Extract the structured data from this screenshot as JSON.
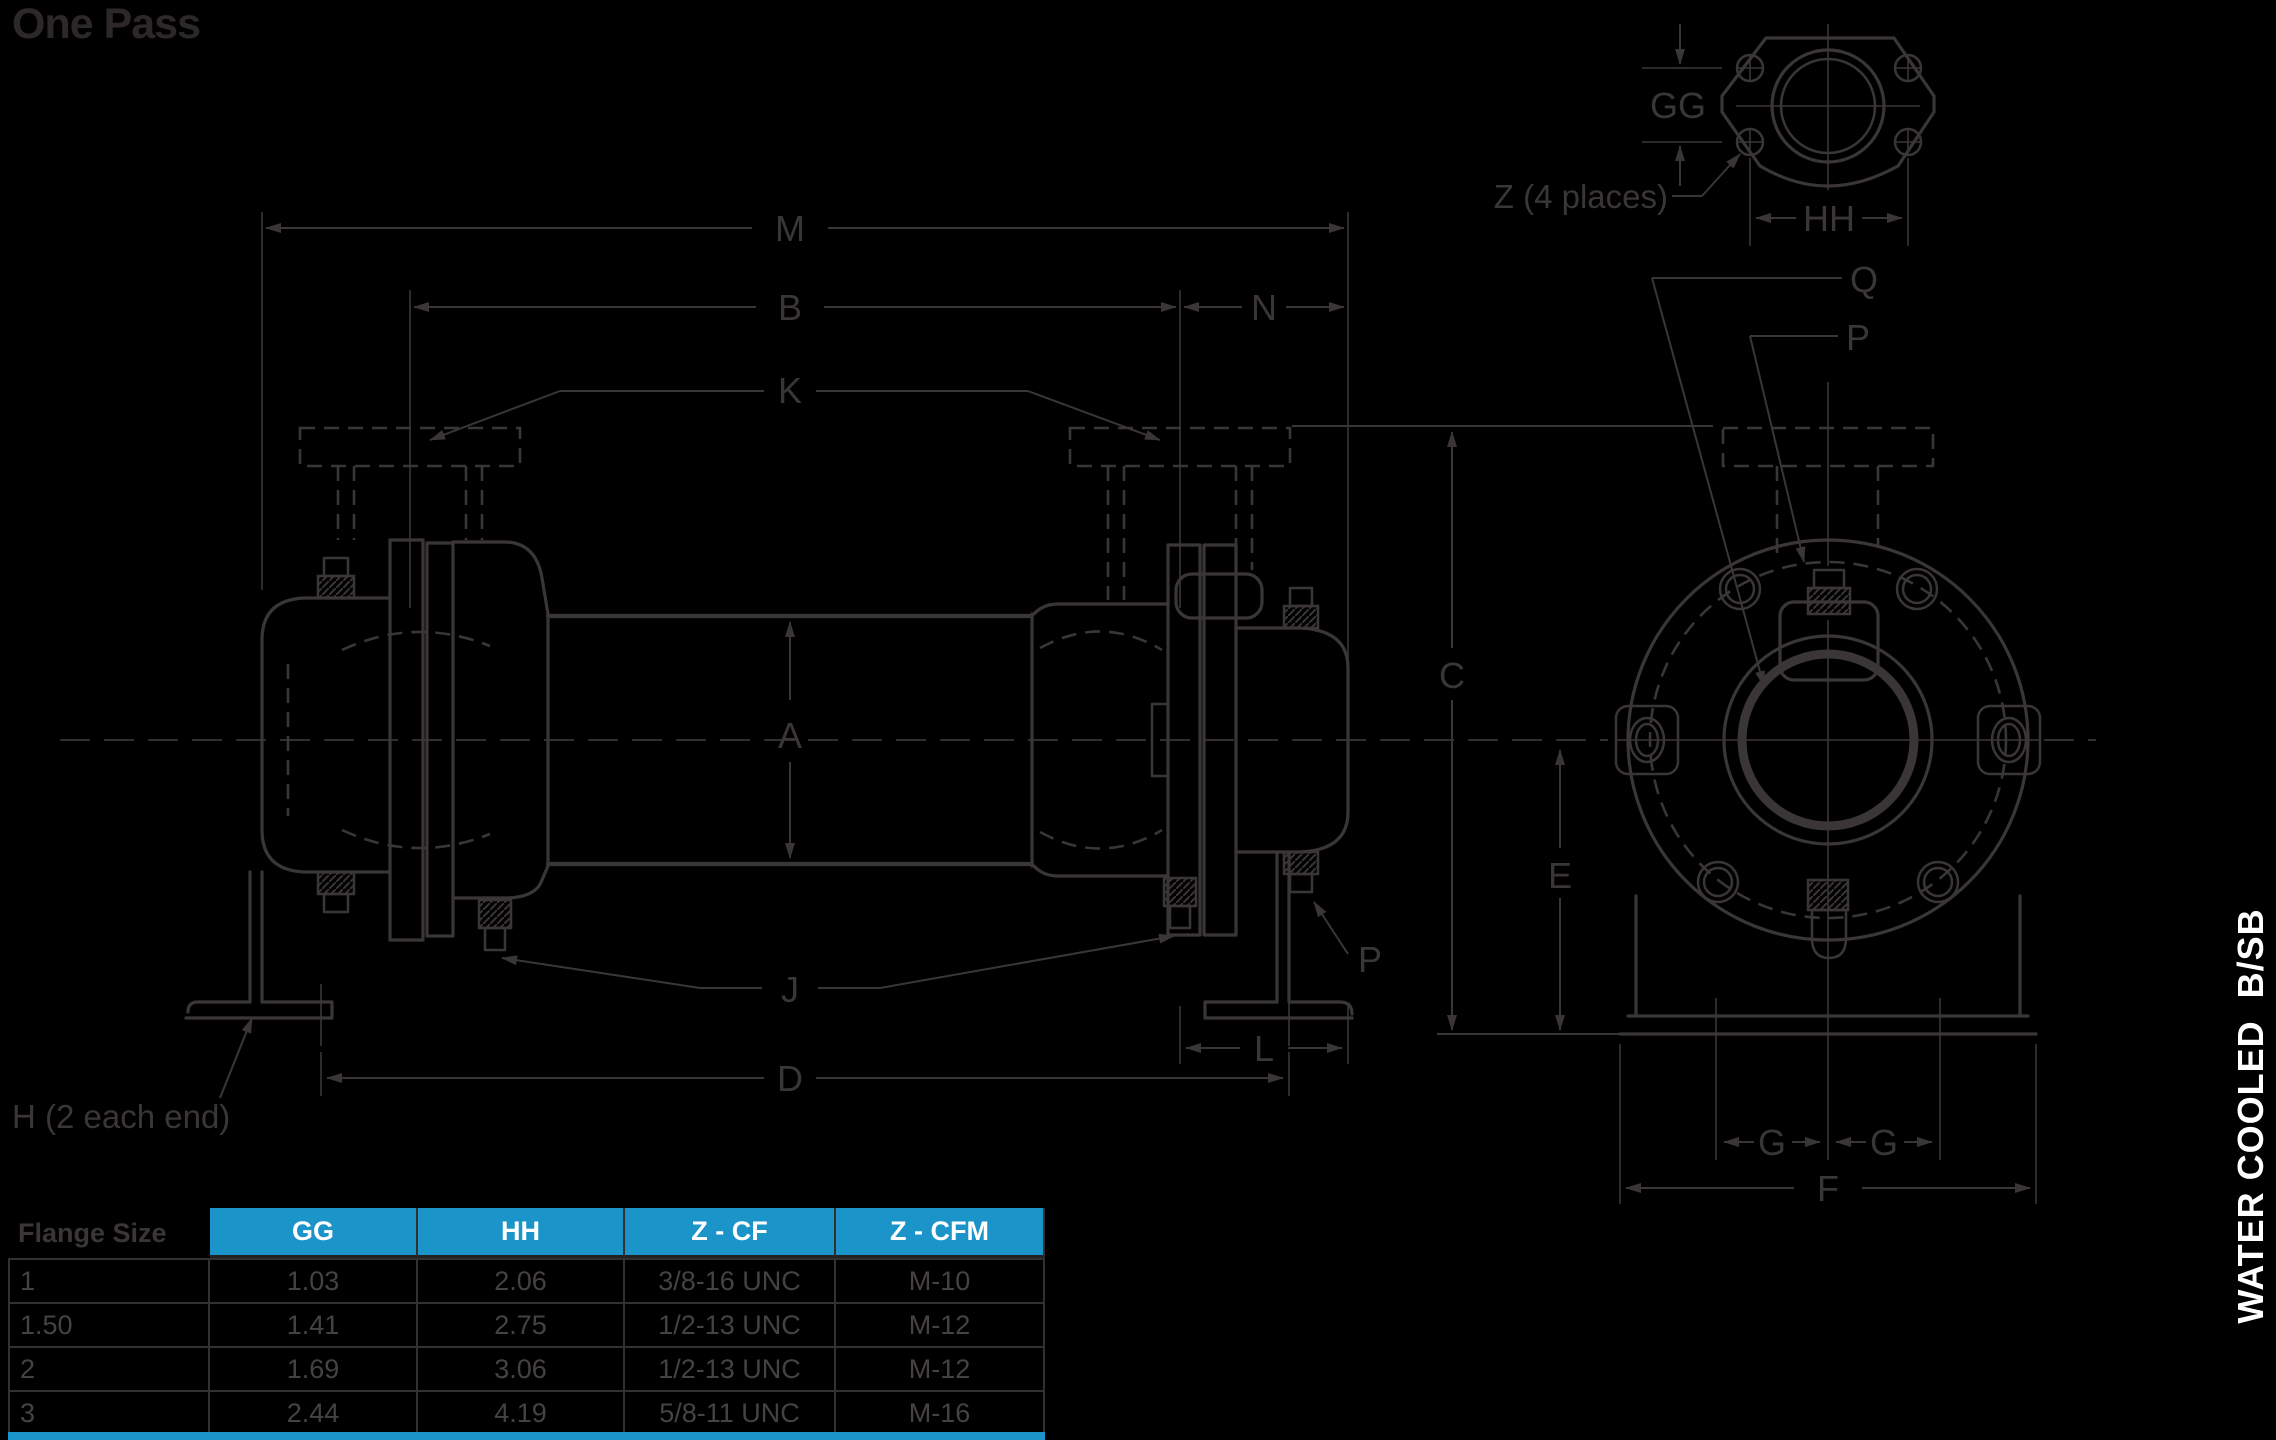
{
  "header": {
    "title": "One Pass"
  },
  "sidebar_label": "WATER COOLED  B/SB",
  "drawing": {
    "side_view_dims": {
      "M": "M",
      "B": "B",
      "N": "N",
      "K": "K",
      "A": "A",
      "J": "J",
      "D": "D",
      "L": "L",
      "P": "P",
      "H_note": "H (2 each end)"
    },
    "end_view_dims": {
      "C": "C",
      "E": "E",
      "Q": "Q",
      "P": "P",
      "G_left": "G",
      "G_right": "G",
      "F": "F"
    },
    "flange_detail_dims": {
      "GG": "GG",
      "HH": "HH",
      "Z_note": "Z (4 places)"
    }
  },
  "flange_table": {
    "columns": [
      "Flange Size",
      "GG",
      "HH",
      "Z - CF",
      "Z - CFM"
    ],
    "rows": [
      [
        "1",
        "1.03",
        "2.06",
        "3/8-16 UNC",
        "M-10"
      ],
      [
        "1.50",
        "1.41",
        "2.75",
        "1/2-13 UNC",
        "M-12"
      ],
      [
        "2",
        "1.69",
        "3.06",
        "1/2-13 UNC",
        "M-12"
      ],
      [
        "3",
        "2.44",
        "4.19",
        "5/8-11 UNC",
        "M-16"
      ]
    ]
  },
  "colors": {
    "accent_blue": "#1b95c9",
    "line": "#3a3637",
    "table_text": "#464243",
    "title_text": "#2c2829",
    "header_text": "#ffffff",
    "background": "#000000"
  }
}
